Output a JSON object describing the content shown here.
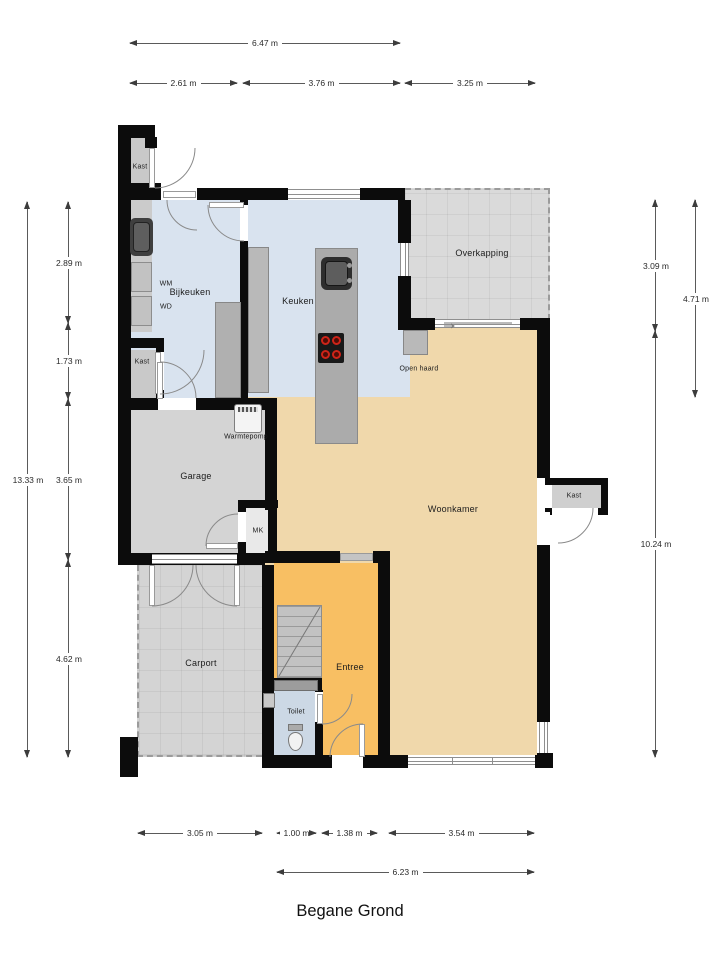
{
  "title": "Begane Grond",
  "dims": {
    "top": [
      "6.47 m",
      "2.61 m",
      "3.76 m",
      "3.25 m"
    ],
    "left": [
      "13.33 m",
      "2.89 m",
      "1.73 m",
      "3.65 m",
      "4.62 m"
    ],
    "right": [
      "3.09 m",
      "4.71 m",
      "10.24 m"
    ],
    "bottom": [
      "3.05 m",
      "1.00 m",
      "1.38 m",
      "3.54 m",
      "6.23 m"
    ]
  },
  "rooms": {
    "kast_tl": "Kast",
    "bijkeuken": "Bijkeuken",
    "wm": "WM",
    "wd": "WD",
    "kast_left": "Kast",
    "keuken": "Keuken",
    "overkapping": "Overkapping",
    "open_haard": "Open haard",
    "warmtepomp": "Warmtepomp",
    "garage": "Garage",
    "mk": "MK",
    "woonkamer": "Woonkamer",
    "kast_right": "Kast",
    "carport": "Carport",
    "entree": "Entree",
    "toilet": "Toilet"
  },
  "colors": {
    "wall": "#0c0c0c",
    "kitchen_floor": "#d9e3ef",
    "living_floor": "#f0d8ab",
    "entry_floor": "#f8bf63",
    "toilet_floor": "#ccd8e5",
    "garage_floor": "#d4d4d4",
    "outdoor_floor": "#dadada",
    "closet_floor": "#c9c9c9",
    "counter": "#b4b4b4",
    "burner_red": "#ce2418"
  }
}
